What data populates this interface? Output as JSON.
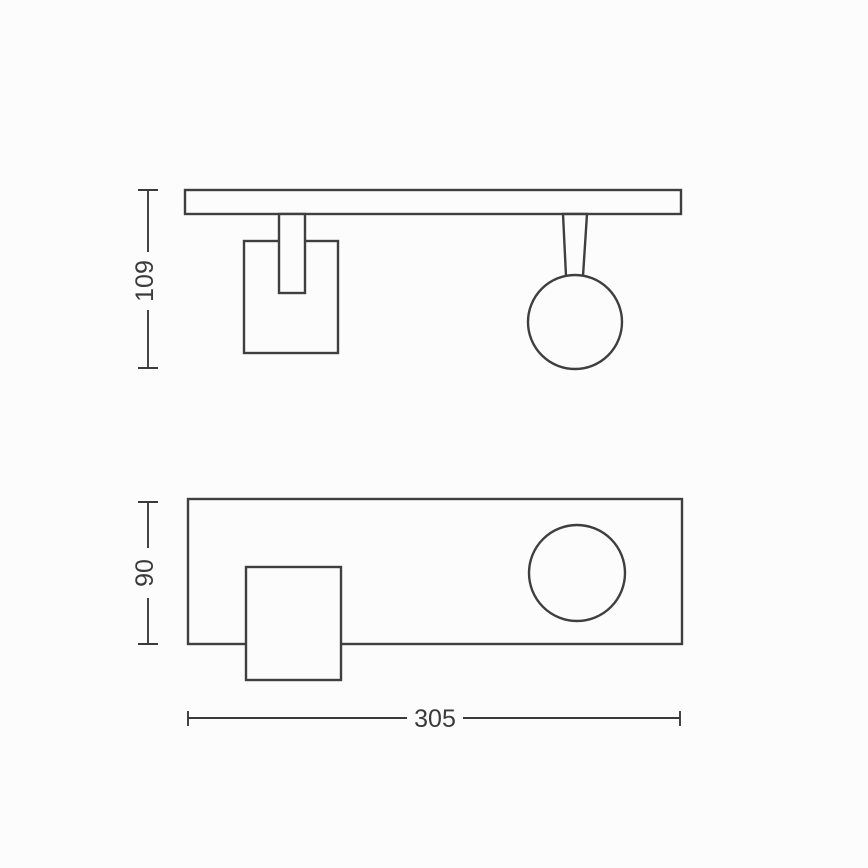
{
  "drawing": {
    "kind": "technical-dimension-drawing",
    "labels": {
      "side_height": "109",
      "plan_depth": "90",
      "plan_width": "305"
    },
    "colors": {
      "line": "#3f3f3f",
      "text": "#3a3a3a",
      "background": "#fcfcfc"
    }
  }
}
